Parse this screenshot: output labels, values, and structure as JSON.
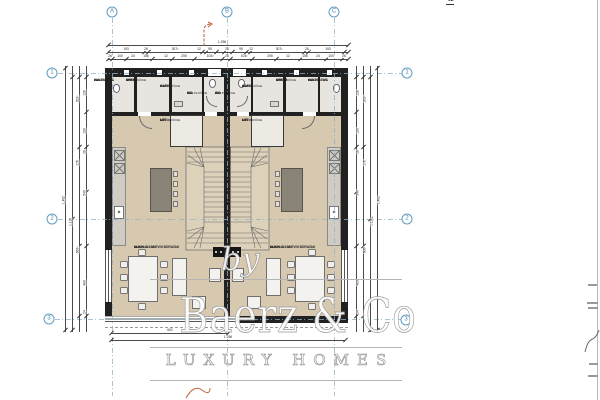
{
  "watermark": {
    "by": "by",
    "brand": "Baerz & Co",
    "tagline": "LUXURY HOMES"
  },
  "area_table": {
    "prev_rows": [
      {
        "num": "0",
        "name": "SPREM",
        "value": "3.14"
      },
      {
        "num": "0",
        "name": "VANJSKI WC",
        "value": "2.01"
      },
      {
        "num": "0",
        "name": "WC",
        "value": "2.40"
      }
    ],
    "prev_total": "74.32 m²",
    "section_header": "02",
    "rows": [
      {
        "num": "0",
        "name": "GARD",
        "value": "4.13"
      },
      {
        "num": "0",
        "name": "KUHINJA I DNEVNI BORAVAK",
        "value": "61.34",
        "cls": "tall"
      },
      {
        "num": "0",
        "name": "LIFT",
        "value": "1.20"
      },
      {
        "num": "0",
        "name": "SPREM",
        "value": "3.14"
      },
      {
        "num": "0",
        "name": "VANJSKI WC",
        "value": "2.01"
      },
      {
        "num": "0",
        "name": "WC",
        "value": "2.40"
      }
    ],
    "section_total": "74.32 m²",
    "grand_total": "148.44 m²"
  },
  "grid_axes": {
    "top": [
      {
        "label": "A",
        "x": 112,
        "y": 12
      },
      {
        "label": "B",
        "x": 227,
        "y": 12
      },
      {
        "label": "C",
        "x": 334,
        "y": 12
      }
    ],
    "left": [
      {
        "label": "1",
        "x": 52,
        "y": 73
      },
      {
        "label": "2",
        "x": 52,
        "y": 219
      },
      {
        "label": "3",
        "x": 49,
        "y": 319
      }
    ],
    "right": [
      {
        "label": "1",
        "x": 407,
        "y": 73
      },
      {
        "label": "2",
        "x": 407,
        "y": 219
      },
      {
        "label": "3",
        "x": 406,
        "y": 320
      }
    ]
  },
  "dim_labels": [
    {
      "t": "1.296",
      "x": 222,
      "y": 41
    },
    {
      "t": "193",
      "x": 126,
      "y": 47.5
    },
    {
      "t": "26",
      "x": 146,
      "y": 47.5
    },
    {
      "t": "307²",
      "x": 175,
      "y": 47.5
    },
    {
      "t": "12",
      "x": 199,
      "y": 47.5
    },
    {
      "t": "95",
      "x": 210,
      "y": 47.5
    },
    {
      "t": "26",
      "x": 227,
      "y": 47.5
    },
    {
      "t": "95",
      "x": 241,
      "y": 47.5
    },
    {
      "t": "12",
      "x": 251,
      "y": 47.5
    },
    {
      "t": "307²",
      "x": 279,
      "y": 47.5
    },
    {
      "t": "26",
      "x": 307,
      "y": 47.5
    },
    {
      "t": "193",
      "x": 328,
      "y": 47.5
    },
    {
      "t": "26",
      "x": 110,
      "y": 54.5
    },
    {
      "t": "100",
      "x": 120,
      "y": 54.5
    },
    {
      "t": "24",
      "x": 133,
      "y": 54.5
    },
    {
      "t": "156",
      "x": 146,
      "y": 54.5
    },
    {
      "t": "12",
      "x": 166,
      "y": 54.5
    },
    {
      "t": "205",
      "x": 184,
      "y": 54.5
    },
    {
      "t": "104²",
      "x": 210,
      "y": 54.5
    },
    {
      "t": "26",
      "x": 227,
      "y": 54.5
    },
    {
      "t": "104²",
      "x": 244,
      "y": 54.5
    },
    {
      "t": "205",
      "x": 270,
      "y": 54.5
    },
    {
      "t": "12",
      "x": 288,
      "y": 54.5
    },
    {
      "t": "156",
      "x": 305,
      "y": 54.5
    },
    {
      "t": "24",
      "x": 318,
      "y": 54.5
    },
    {
      "t": "100",
      "x": 331,
      "y": 54.5
    },
    {
      "t": "26",
      "x": 344,
      "y": 54.5
    },
    {
      "t": "602",
      "x": 170,
      "y": 328.5
    },
    {
      "t": "1.296",
      "x": 228,
      "y": 335.5
    },
    {
      "t": "1.462",
      "x": 64,
      "y": 200,
      "cls": "rot"
    },
    {
      "t": "1.116",
      "x": 71,
      "y": 222,
      "cls": "rot"
    },
    {
      "t": "600²",
      "x": 78,
      "y": 250,
      "cls": "rot"
    },
    {
      "t": "176",
      "x": 78,
      "y": 163,
      "cls": "rot"
    },
    {
      "t": "202²",
      "x": 78,
      "y": 99,
      "cls": "rot"
    },
    {
      "t": "540",
      "x": 85,
      "y": 193,
      "cls": "rot"
    },
    {
      "t": "190",
      "x": 85,
      "y": 131,
      "cls": "rot"
    },
    {
      "t": "128",
      "x": 85,
      "y": 93,
      "cls": "rot"
    },
    {
      "t": "26",
      "x": 85,
      "y": 152,
      "cls": "rot"
    },
    {
      "t": "480",
      "x": 85,
      "y": 283,
      "cls": "rot"
    },
    {
      "t": "24",
      "x": 85,
      "y": 312,
      "cls": "rot"
    },
    {
      "t": "1.462",
      "x": 379,
      "y": 200,
      "cls": "rot"
    },
    {
      "t": "1.116",
      "x": 372,
      "y": 222,
      "cls": "rot"
    },
    {
      "t": "600²",
      "x": 365,
      "y": 250,
      "cls": "rot"
    },
    {
      "t": "176",
      "x": 365,
      "y": 163,
      "cls": "rot"
    },
    {
      "t": "202²",
      "x": 365,
      "y": 99,
      "cls": "rot"
    },
    {
      "t": "540",
      "x": 358,
      "y": 193,
      "cls": "rot"
    },
    {
      "t": "190",
      "x": 358,
      "y": 131,
      "cls": "rot"
    },
    {
      "t": "128",
      "x": 358,
      "y": 93,
      "cls": "rot"
    },
    {
      "t": "26",
      "x": 358,
      "y": 152,
      "cls": "rot"
    },
    {
      "t": "480",
      "x": 358,
      "y": 283,
      "cls": "rot"
    },
    {
      "t": "24",
      "x": 358,
      "y": 312,
      "cls": "rot"
    }
  ],
  "ticks": [
    {
      "x": 108,
      "y": 45
    },
    {
      "x": 348,
      "y": 45
    },
    {
      "x": 108,
      "y": 52
    },
    {
      "x": 144,
      "y": 52
    },
    {
      "x": 148,
      "y": 52
    },
    {
      "x": 202,
      "y": 52
    },
    {
      "x": 206,
      "y": 52
    },
    {
      "x": 216,
      "y": 52
    },
    {
      "x": 224,
      "y": 52
    },
    {
      "x": 232,
      "y": 52
    },
    {
      "x": 246,
      "y": 52
    },
    {
      "x": 250,
      "y": 52
    },
    {
      "x": 304,
      "y": 52
    },
    {
      "x": 308,
      "y": 52
    },
    {
      "x": 344,
      "y": 52
    },
    {
      "x": 348,
      "y": 52
    },
    {
      "x": 108,
      "y": 59
    },
    {
      "x": 112,
      "y": 59
    },
    {
      "x": 126,
      "y": 59
    },
    {
      "x": 152,
      "y": 59
    },
    {
      "x": 172,
      "y": 59
    },
    {
      "x": 194,
      "y": 59
    },
    {
      "x": 222,
      "y": 59
    },
    {
      "x": 230,
      "y": 59
    },
    {
      "x": 252,
      "y": 59
    },
    {
      "x": 276,
      "y": 59
    },
    {
      "x": 300,
      "y": 59
    },
    {
      "x": 326,
      "y": 59
    },
    {
      "x": 342,
      "y": 59
    },
    {
      "x": 348,
      "y": 59
    },
    {
      "x": 111,
      "y": 333
    },
    {
      "x": 228,
      "y": 333
    },
    {
      "x": 111,
      "y": 340
    },
    {
      "x": 345,
      "y": 340
    },
    {
      "x": 65,
      "y": 68
    },
    {
      "x": 65,
      "y": 330
    },
    {
      "x": 72,
      "y": 77
    },
    {
      "x": 72,
      "y": 219
    },
    {
      "x": 72,
      "y": 330
    },
    {
      "x": 79,
      "y": 77
    },
    {
      "x": 79,
      "y": 147
    },
    {
      "x": 79,
      "y": 246
    },
    {
      "x": 79,
      "y": 316
    },
    {
      "x": 86,
      "y": 77
    },
    {
      "x": 86,
      "y": 112
    },
    {
      "x": 86,
      "y": 147
    },
    {
      "x": 86,
      "y": 192
    },
    {
      "x": 86,
      "y": 246
    },
    {
      "x": 86,
      "y": 316
    },
    {
      "x": 377,
      "y": 68
    },
    {
      "x": 377,
      "y": 330
    },
    {
      "x": 370,
      "y": 77
    },
    {
      "x": 370,
      "y": 219
    },
    {
      "x": 370,
      "y": 330
    },
    {
      "x": 363,
      "y": 77
    },
    {
      "x": 363,
      "y": 147
    },
    {
      "x": 363,
      "y": 246
    },
    {
      "x": 363,
      "y": 316
    },
    {
      "x": 356,
      "y": 77
    },
    {
      "x": 356,
      "y": 112
    },
    {
      "x": 356,
      "y": 147
    },
    {
      "x": 356,
      "y": 192
    },
    {
      "x": 356,
      "y": 246
    },
    {
      "x": 356,
      "y": 316
    }
  ],
  "rooms": [
    {
      "name": "VANJSKI WC",
      "num": "0",
      "area": "2.01",
      "floor": "KER.PLOČICE",
      "x": 120,
      "y": 79
    },
    {
      "name": "SPREM",
      "num": "0",
      "area": "3.14 m²",
      "floor": "KER.PLOČICE",
      "x": 152,
      "y": 79
    },
    {
      "name": "GARD",
      "num": "0",
      "area": "4.13",
      "floor": "KER.PLOČICE",
      "x": 186,
      "y": 85
    },
    {
      "name": "WC",
      "num": "0",
      "area": "2.40",
      "floor": "KER.PLOČICE",
      "x": 213,
      "y": 92
    },
    {
      "name": "WC",
      "num": "0",
      "area": "2.40",
      "floor": "KER.PLOČICE",
      "x": 241,
      "y": 92
    },
    {
      "name": "GARD",
      "num": "0",
      "area": "4.13",
      "floor": "KER.PLOČICE",
      "x": 268,
      "y": 85
    },
    {
      "name": "SPREM",
      "num": "0",
      "area": "3.14 m²",
      "floor": "KER.PLOČICE",
      "x": 302,
      "y": 79
    },
    {
      "name": "VANJSKI WC",
      "num": "0",
      "area": "2.01",
      "floor": "KER.PLOČICE",
      "x": 334,
      "y": 79
    },
    {
      "name": "LIFT",
      "num": "0",
      "area": "A 1.2 m²",
      "floor": "KER.PLOČICE",
      "x": 186,
      "y": 119,
      "cls": "lift-label"
    },
    {
      "name": "LIFT",
      "num": "0",
      "area": "A 1.2 m²",
      "floor": "KER.PLOČICE",
      "x": 268,
      "y": 119,
      "cls": "lift-label"
    },
    {
      "name": "KUHINJA I DNEVNI BORAVAK",
      "num": "0",
      "area": "61.34",
      "floor": "KER.PLOČICE",
      "x": 160,
      "y": 246
    },
    {
      "name": "KUHINJA I DNEVNI BORAVAK",
      "num": "0",
      "area": "61.34",
      "floor": "KER.PLOČICE",
      "x": 296,
      "y": 246
    }
  ],
  "colors": {
    "floor_living": "#d7c9b0",
    "floor_rooms": "#e8e5e0",
    "wall": "#212121",
    "axis_blue": "#5f9cc0",
    "red_mark": "#bf5b36",
    "watermark": "#ffffff"
  }
}
